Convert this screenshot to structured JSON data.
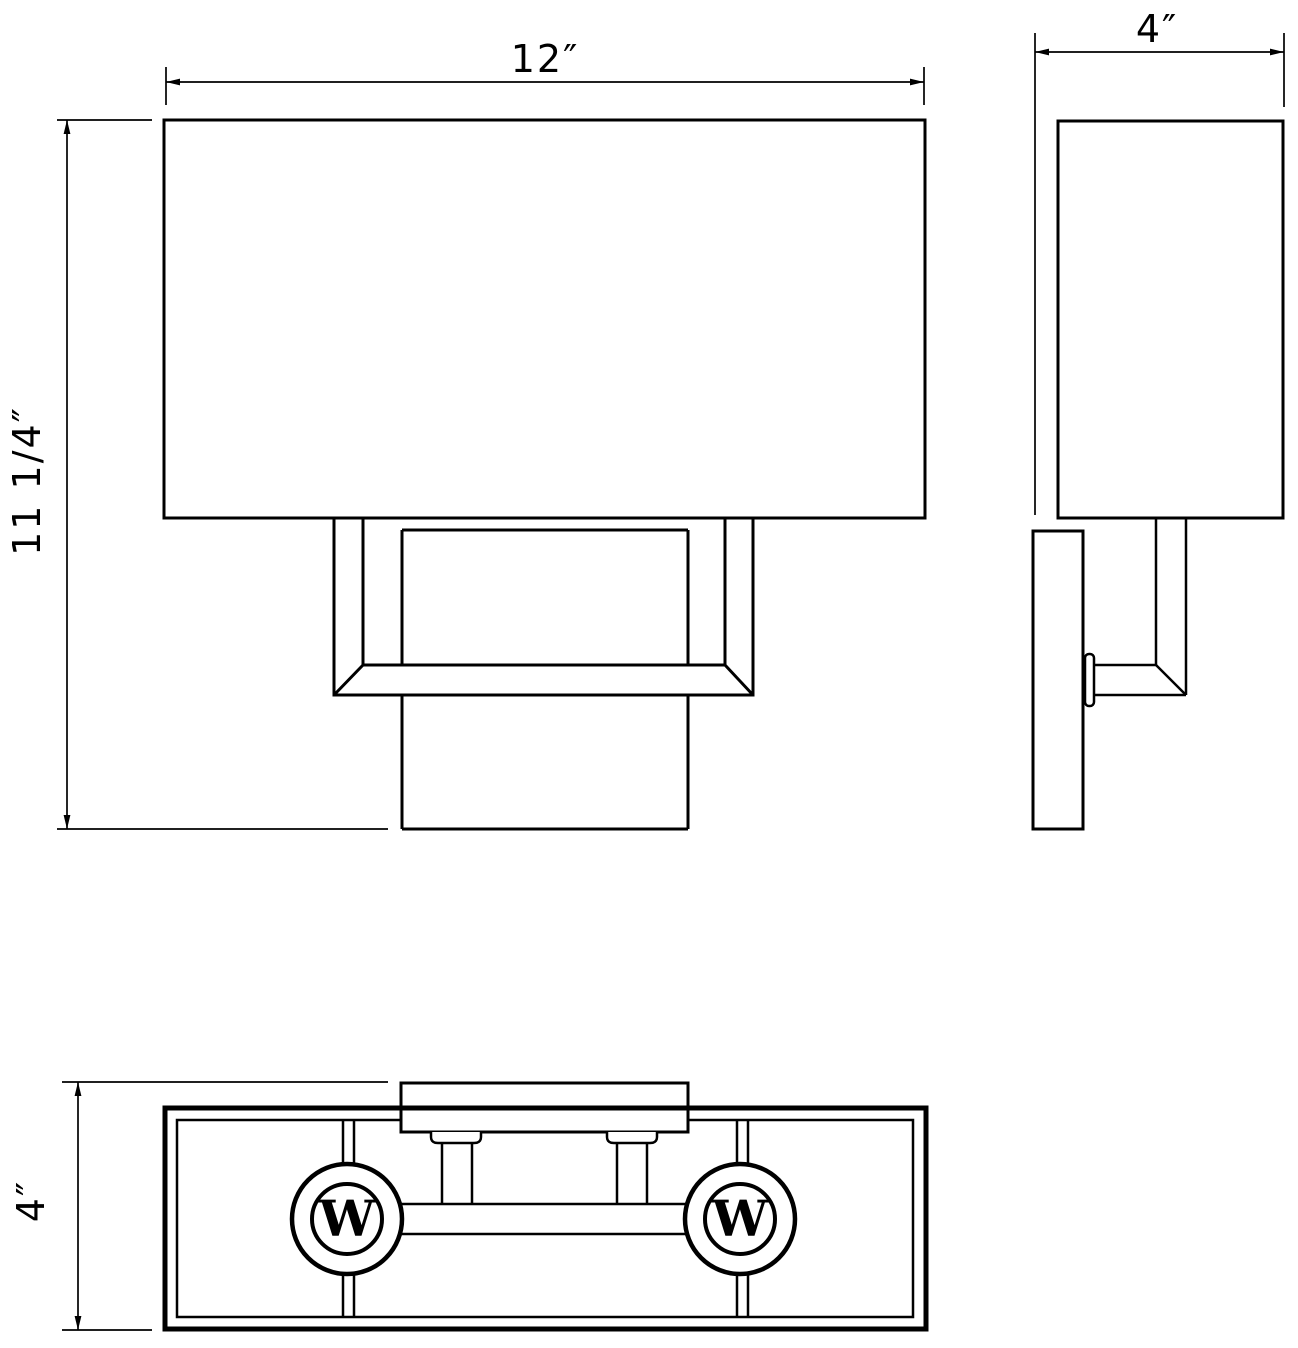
{
  "drawing": {
    "type": "orthographic-dimension-drawing",
    "subject": "two-light rectangular wall sconce",
    "paper_color": "#ffffff",
    "ink_color": "#000000",
    "views": {
      "front": {
        "id": "front-view"
      },
      "side": {
        "id": "side-view"
      },
      "bottom": {
        "id": "bottom-view"
      }
    },
    "dimensions": {
      "front_width": {
        "label": "12″"
      },
      "front_height": {
        "label": "11 1/4″"
      },
      "side_depth": {
        "label": "4″"
      },
      "bottom_depth": {
        "label": "4″"
      }
    },
    "symbols": {
      "lamp_socket": {
        "label": "W",
        "count": 2
      }
    }
  }
}
